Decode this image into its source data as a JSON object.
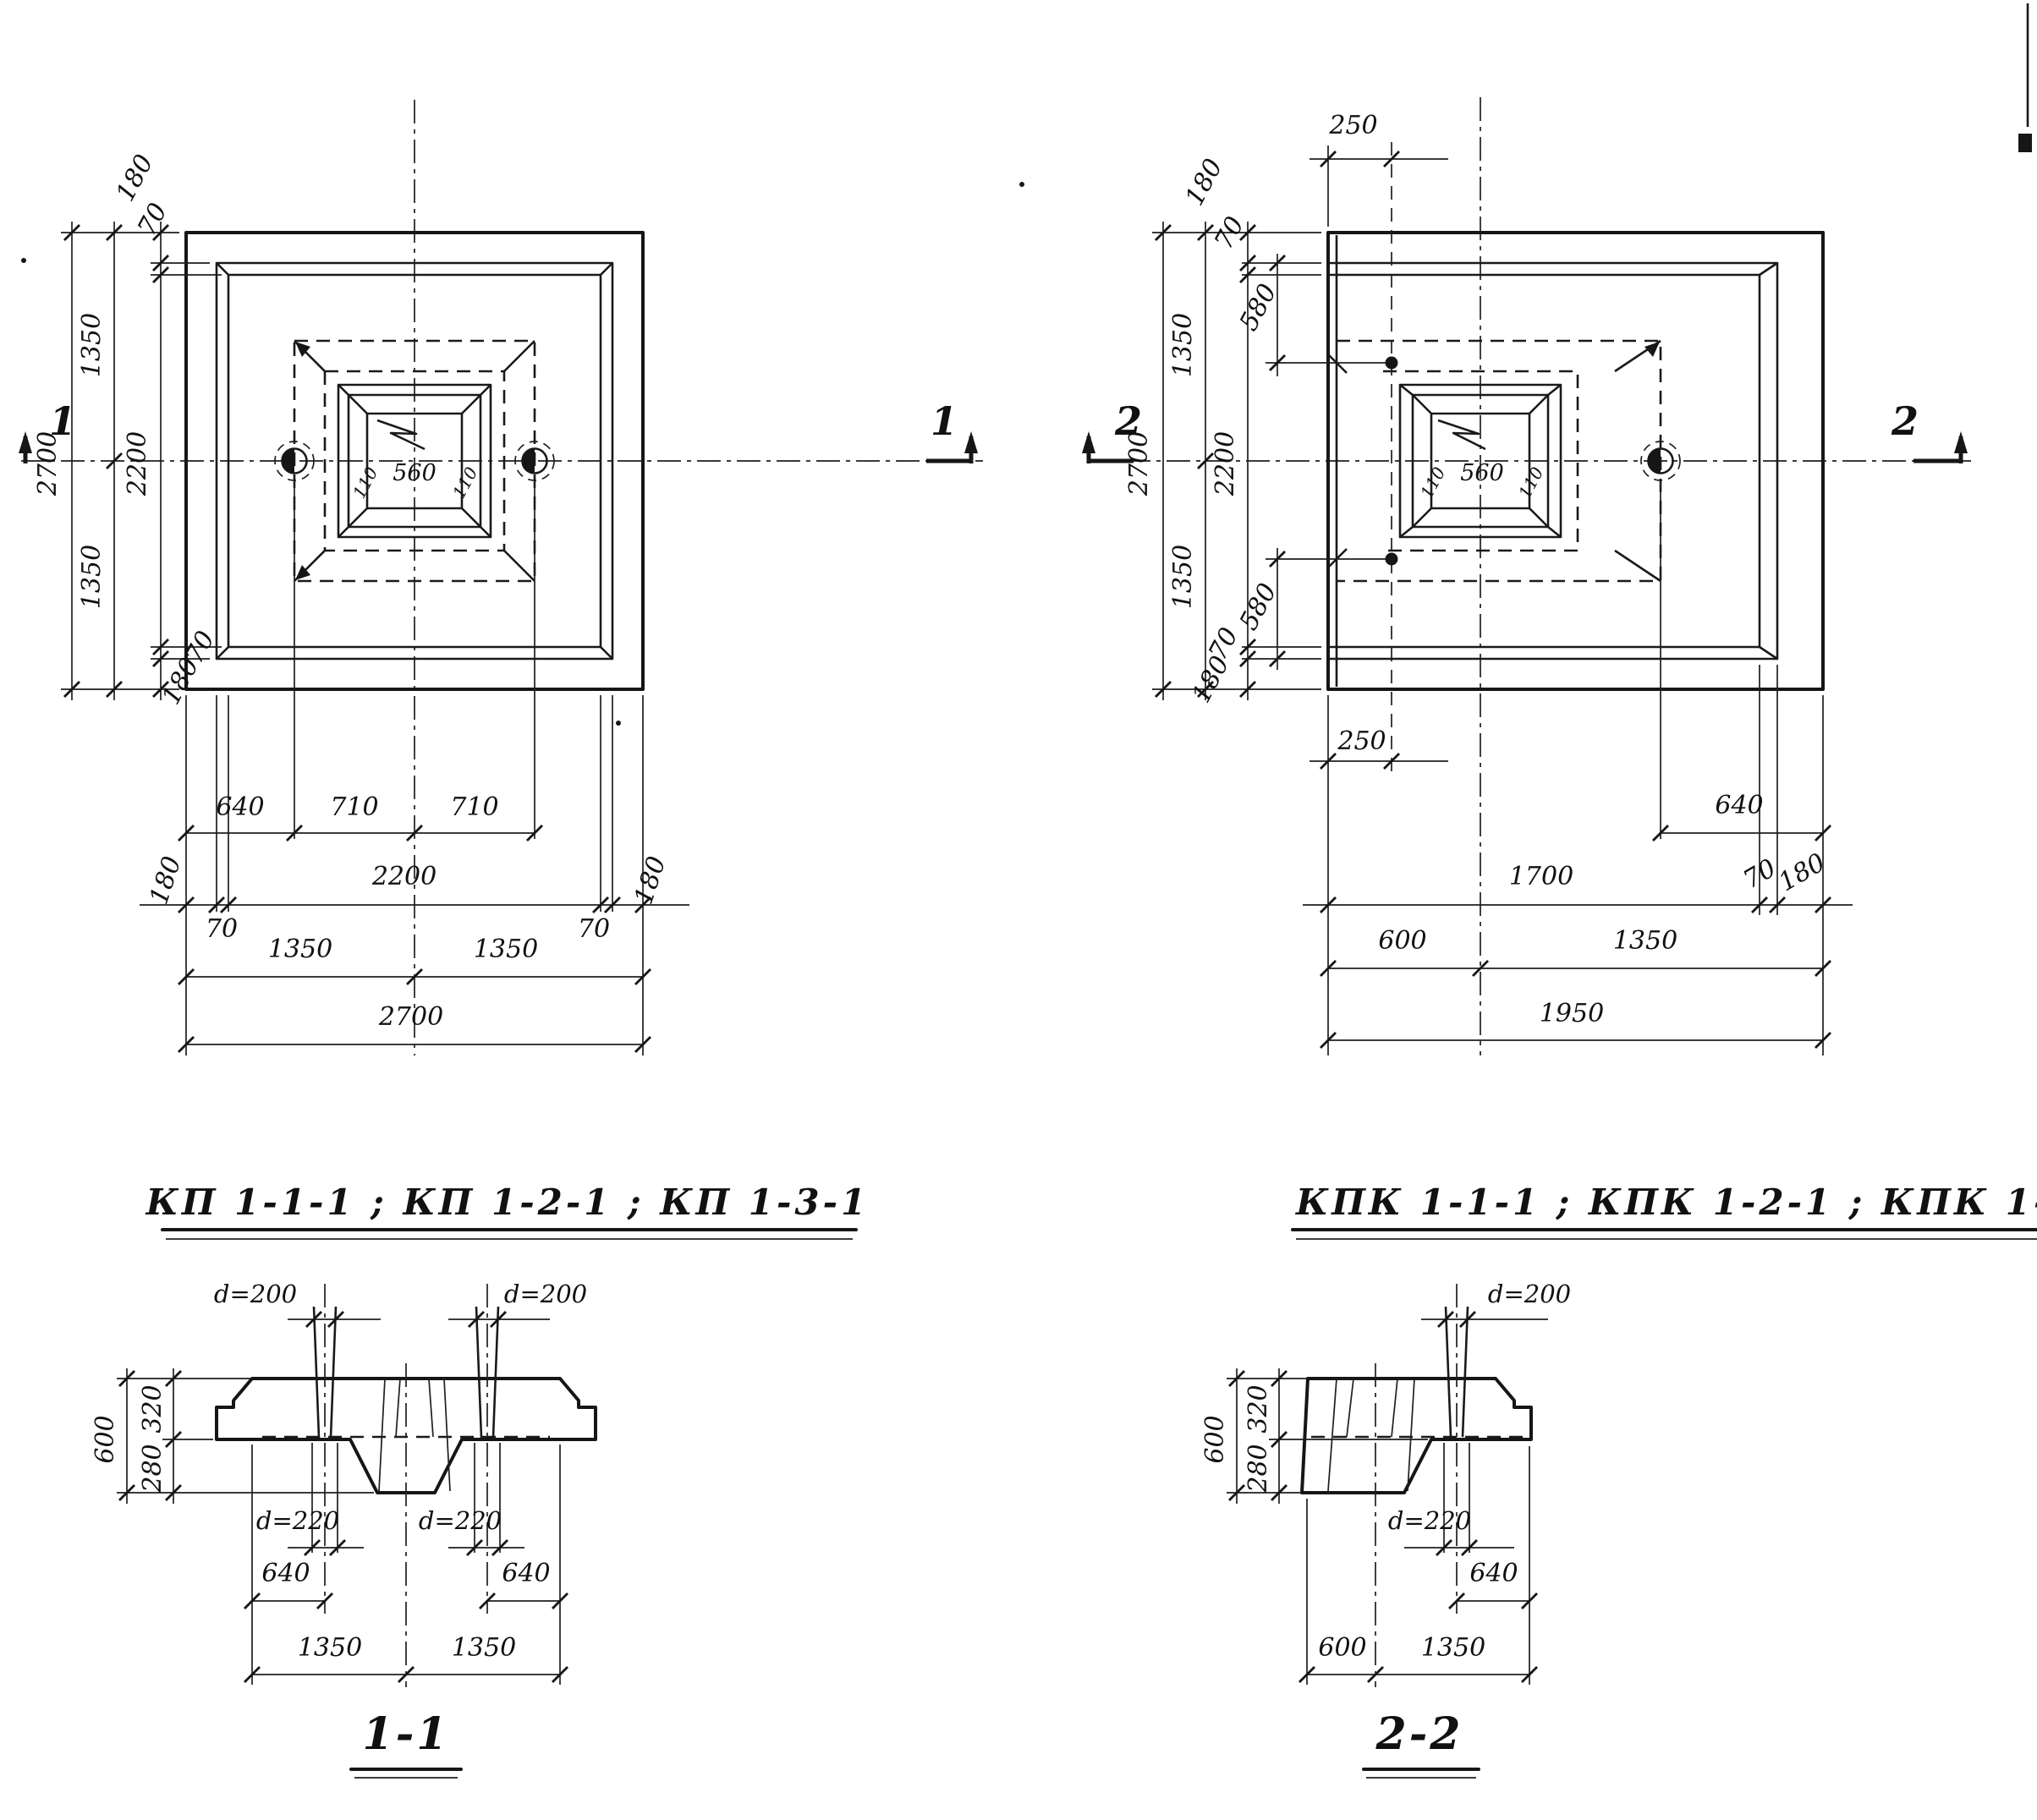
{
  "titles": {
    "left": "КП 1-1-1 ; КП 1-2-1 ; КП 1-3-1",
    "right": "КПК 1-1-1 ; КПК 1-2-1 ; КПК 1-3-1"
  },
  "marks": {
    "s1": "1",
    "s2": "2"
  },
  "plan_kp": {
    "overall": "2700",
    "half": "1350",
    "inner": "2200",
    "edge": "180",
    "step": "70",
    "hole_edge_offset": "640",
    "hole_pitch": "710",
    "socket_opening": "560",
    "socket_wall": "110"
  },
  "plan_kpk": {
    "depth": "2700",
    "width": "1950",
    "half": "1350",
    "inner": "2200",
    "edge": "180",
    "step": "70",
    "hole_edge_offset": "640",
    "dowel_edge_offset": "250",
    "dowel_axis_offset": "580",
    "long_part": "1700",
    "short_part": "600",
    "socket_opening": "560",
    "socket_wall": "110"
  },
  "section_11": {
    "label": "1-1",
    "thickness": "600",
    "top_part": "320",
    "bottom_part": "280",
    "hole_top": "d=200",
    "hole_bottom": "d=220",
    "hole_to_edge": "640",
    "half_span": "1350"
  },
  "section_22": {
    "label": "2-2",
    "thickness": "600",
    "top_part": "320",
    "bottom_part": "280",
    "hole_top": "d=200",
    "hole_bottom": "d=220",
    "hole_to_edge": "640",
    "short_span": "600",
    "long_span": "1350"
  }
}
